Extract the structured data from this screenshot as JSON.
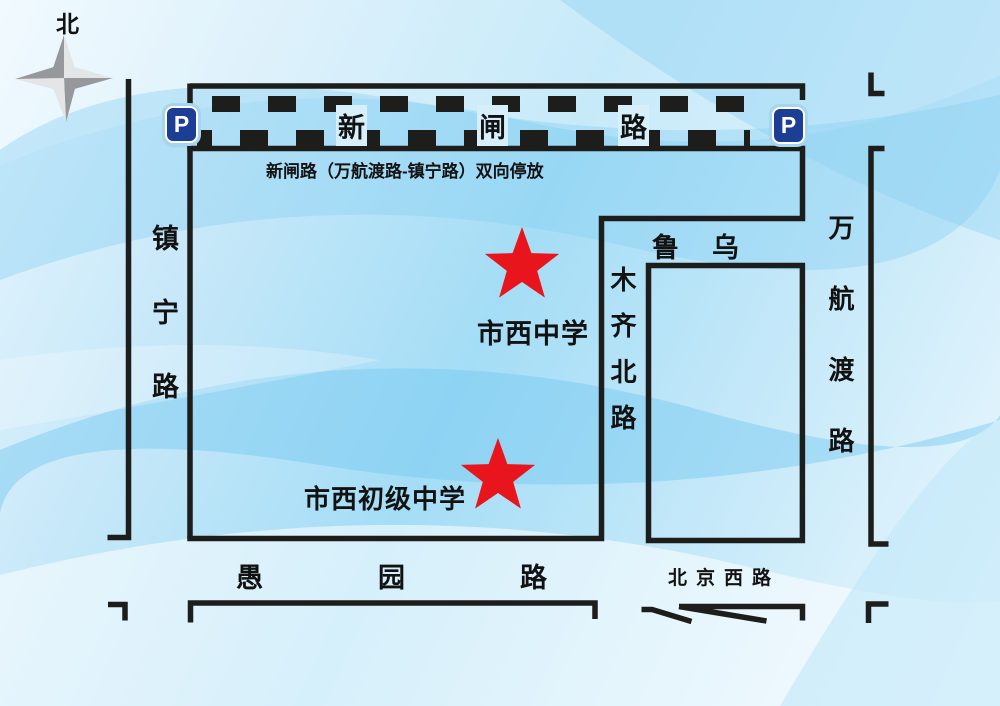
{
  "map": {
    "compass_label": "北",
    "parking_letter": "P"
  },
  "roads": {
    "xinzha": {
      "label": "新闸路",
      "note": "新闸路（万航渡路-镇宁路）双向停放"
    },
    "zhenning": {
      "label": "镇宁路"
    },
    "wulumuqi_north": {
      "label_horizontal": "鲁乌",
      "label_vertical": "木齐北路"
    },
    "wanhangdu": {
      "label": "万航渡路"
    },
    "yuyuan": {
      "label": "愚园路"
    },
    "beijing_west": {
      "label": "北京西路"
    }
  },
  "schools": [
    {
      "name": "市西中学"
    },
    {
      "name": "市西初级中学"
    }
  ],
  "colors": {
    "star_red": "#e8151c",
    "road_line": "#1d1d1b",
    "parking_blue": "#1c3e94",
    "background_blue": "#a4ddf6"
  }
}
